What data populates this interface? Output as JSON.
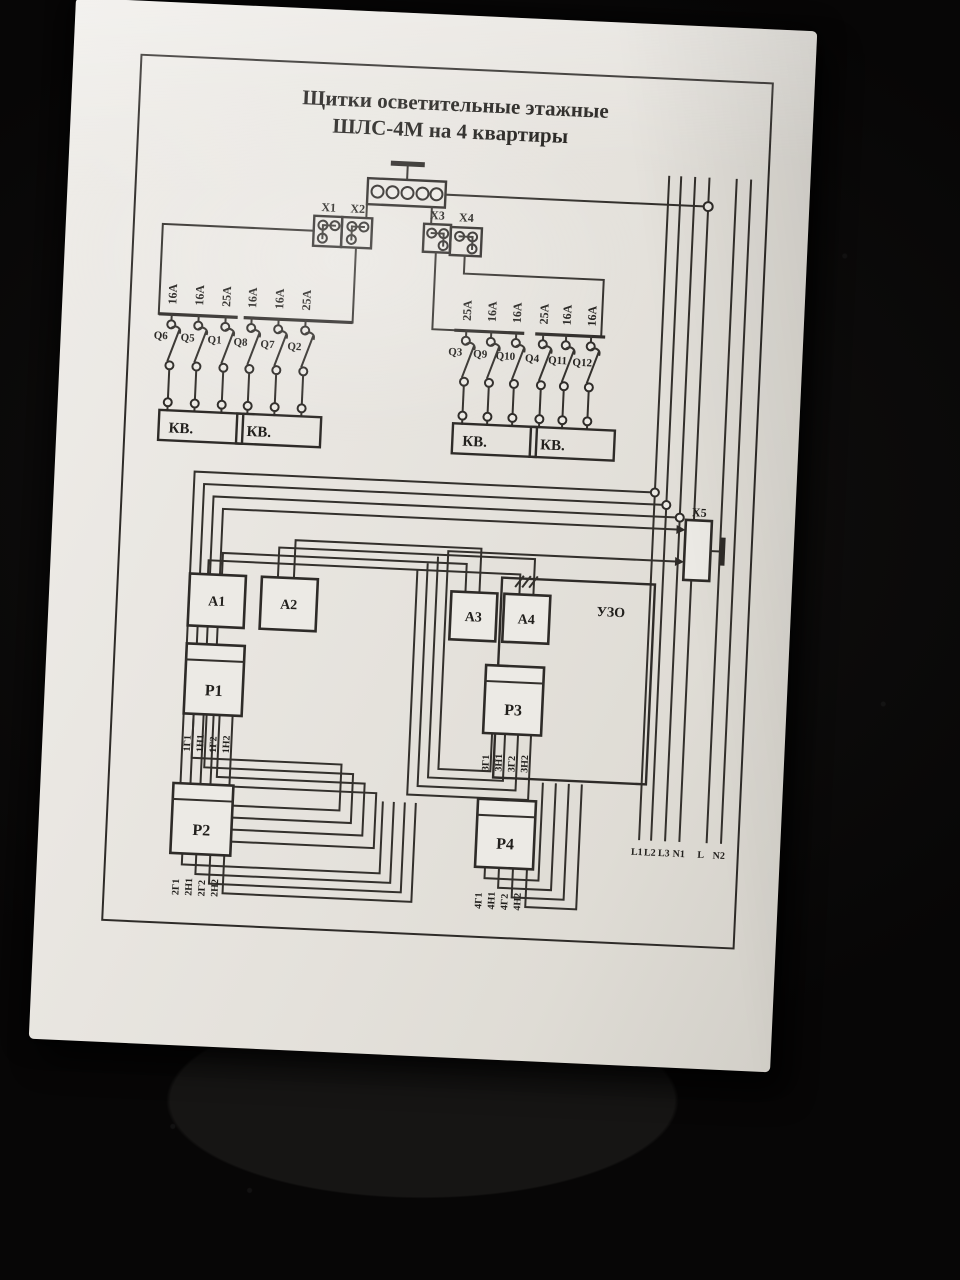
{
  "title": {
    "line1": "Щитки осветительные этажные",
    "line2": "ШЛС-4М  на 4 квартиры"
  },
  "connectors": {
    "x1": "X1",
    "x2": "X2",
    "x3": "X3",
    "x4": "X4",
    "x5": "X5"
  },
  "breakers": {
    "left": {
      "ratings": [
        "16А",
        "16А",
        "25А",
        "16А",
        "16А",
        "25А"
      ],
      "labels": [
        "Q6",
        "Q5",
        "Q1",
        "Q8",
        "Q7",
        "Q2"
      ]
    },
    "right": {
      "ratings": [
        "25А",
        "16А",
        "16А",
        "25А",
        "16А",
        "16А"
      ],
      "labels": [
        "Q3",
        "Q9",
        "Q10",
        "Q4",
        "Q11",
        "Q12"
      ]
    }
  },
  "kv_boxes": [
    "КВ.",
    "КВ.",
    "КВ.",
    "КВ."
  ],
  "modules": {
    "a1": "A1",
    "a2": "A2",
    "a3": "A3",
    "a4": "A4",
    "uzo": "УЗО"
  },
  "relays": {
    "p1": {
      "label": "P1",
      "terminals": [
        "1Г1",
        "1Н1",
        "1Г2",
        "1Н2"
      ]
    },
    "p2": {
      "label": "P2",
      "terminals": [
        "2Г1",
        "2Н1",
        "2Г2",
        "2Н2"
      ]
    },
    "p3": {
      "label": "P3",
      "terminals": [
        "3Г1",
        "3Н1",
        "3Г2",
        "3Н2"
      ]
    },
    "p4": {
      "label": "P4",
      "terminals": [
        "4Г1",
        "4Н1",
        "4Г2",
        "4Н2"
      ]
    }
  },
  "bus_labels": [
    "L1",
    "L2",
    "L3",
    "N1",
    "L",
    "N2"
  ],
  "colors": {
    "paper": "#e9e6e1",
    "ink": "#2e2b28",
    "background": "#080707"
  }
}
